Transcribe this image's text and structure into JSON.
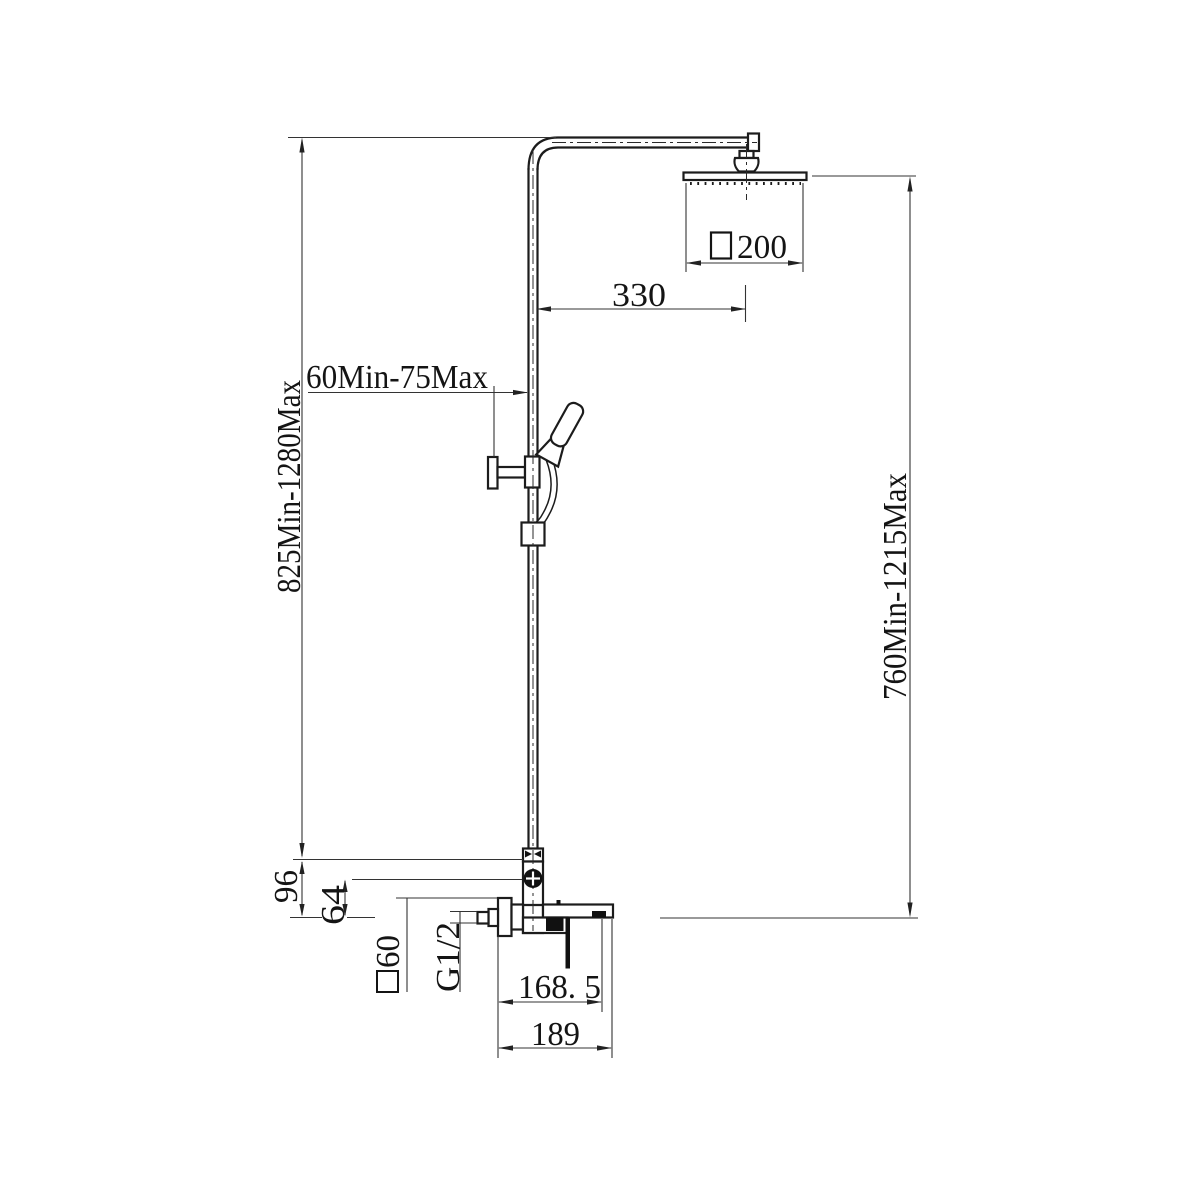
{
  "drawing": {
    "background": "#ffffff",
    "line_color": "#1c1c1c",
    "dim_line_color": "#333333",
    "text_color": "#141414",
    "dimensions": {
      "overall_height": "825Min-1280Max",
      "right_height": "760Min-1215Max",
      "arm_projection": "330",
      "head_size": "200",
      "head_size_prefix": "□",
      "bracket_offset": "60Min-75Max",
      "pipe_to_spout": "96",
      "diverter_to_spout": "64",
      "flange_size": "60",
      "flange_size_prefix": "□",
      "thread": "G1/2",
      "wall_to_outlet": "168. 5",
      "wall_to_spout_tip": "189"
    }
  }
}
